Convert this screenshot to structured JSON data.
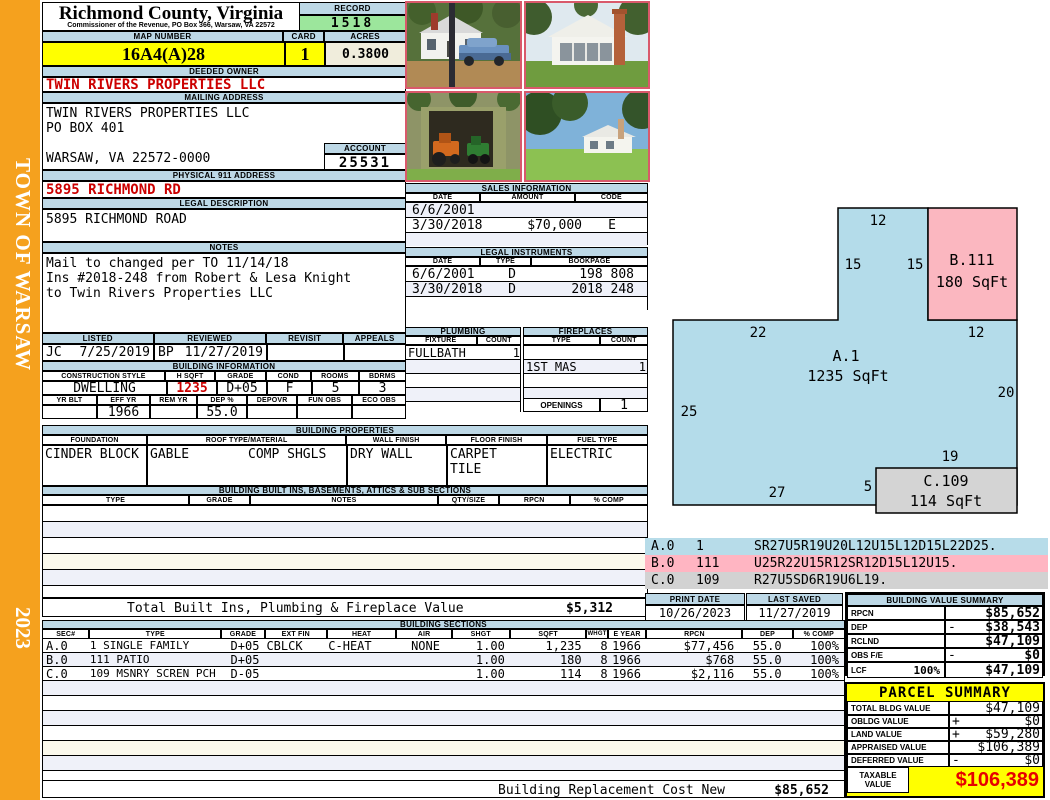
{
  "sidebar": {
    "town": "TOWN OF WARSAW",
    "year": "2023"
  },
  "header": {
    "county": "Richmond County, Virginia",
    "commissioner": "Commissioner of the Revenue, PO Box 366, Warsaw, VA 22572",
    "record_label": "RECORD",
    "record_value": "1518",
    "map_label": "MAP NUMBER",
    "map_value": "16A4(A)28",
    "card_label": "CARD",
    "card_value": "1",
    "acres_label": "ACRES",
    "acres_value": "0.3800"
  },
  "owner": {
    "label": "DEEDED OWNER",
    "value": "TWIN RIVERS PROPERTIES LLC"
  },
  "mailing": {
    "label": "MAILING ADDRESS",
    "line1": "TWIN RIVERS PROPERTIES LLC",
    "line2": "PO BOX 401",
    "line3": "WARSAW, VA 22572-0000"
  },
  "account": {
    "label": "ACCOUNT",
    "value": "25531"
  },
  "physical": {
    "label": "PHYSICAL 911 ADDRESS",
    "value": "5895 RICHMOND RD"
  },
  "legal": {
    "label": "LEGAL DESCRIPTION",
    "value": "5895 RICHMOND ROAD"
  },
  "notes": {
    "label": "NOTES",
    "line1": "Mail to changed per TO 11/14/18",
    "line2": "Ins #2018-248 from Robert & Lesa Knight",
    "line3": "to Twin Rivers Properties LLC"
  },
  "review": {
    "listed_label": "LISTED",
    "reviewed_label": "REVIEWED",
    "revisit_label": "REVISIT",
    "appeals_label": "APPEALS",
    "listed_by": "JC",
    "listed_date": "7/25/2019",
    "reviewed_by": "BP",
    "reviewed_date": "11/27/2019"
  },
  "building_info": {
    "title": "BUILDING INFORMATION",
    "h1": [
      "CONSTRUCTION STYLE",
      "H SQFT",
      "GRADE",
      "COND",
      "ROOMS",
      "BDRMS"
    ],
    "v1": [
      "DWELLING",
      "1235",
      "D+05",
      "F",
      "5",
      "3"
    ],
    "h2": [
      "YR BLT",
      "EFF YR",
      "REM YR",
      "DEP %",
      "DEPOVR",
      "FUN OBS",
      "ECO OBS"
    ],
    "v2": [
      "",
      "1966",
      "",
      "55.0",
      "",
      "",
      ""
    ]
  },
  "sales": {
    "title": "SALES INFORMATION",
    "h": [
      "DATE",
      "AMOUNT",
      "CODE"
    ],
    "rows": [
      [
        "6/6/2001",
        "",
        ""
      ],
      [
        "3/30/2018",
        "$70,000",
        "E"
      ],
      [
        "",
        "",
        ""
      ]
    ]
  },
  "instruments": {
    "title": "LEGAL INSTRUMENTS",
    "h": [
      "DATE",
      "TYPE",
      "BOOKPAGE"
    ],
    "rows": [
      [
        "6/6/2001",
        "D",
        "198 808"
      ],
      [
        "3/30/2018",
        "D",
        "2018 248"
      ],
      [
        "",
        "",
        ""
      ]
    ]
  },
  "plumbing": {
    "title": "PLUMBING",
    "h": [
      "FIXTURE",
      "COUNT"
    ],
    "rows": [
      [
        "FULLBATH",
        "1"
      ]
    ]
  },
  "fireplaces": {
    "title": "FIREPLACES",
    "h": [
      "TYPE",
      "COUNT"
    ],
    "rows": [
      [
        "",
        ""
      ],
      [
        "1ST MAS",
        "1"
      ]
    ],
    "openings_label": "OPENINGS",
    "openings_value": "1"
  },
  "properties": {
    "title": "BUILDING PROPERTIES",
    "h": [
      "FOUNDATION",
      "ROOF TYPE/MATERIAL",
      "WALL FINISH",
      "FLOOR FINISH",
      "FUEL TYPE"
    ],
    "foundation": "CINDER BLOCK",
    "roof_type": "GABLE",
    "roof_material": "COMP SHGLS",
    "wall": "DRY WALL",
    "floor1": "CARPET",
    "floor2": "TILE",
    "fuel": "ELECTRIC"
  },
  "builtins": {
    "title": "BUILDING BUILT INS, BASEMENTS, ATTICS & SUB SECTIONS",
    "h": [
      "TYPE",
      "GRADE",
      "NOTES",
      "QTY/SIZE",
      "RPCN",
      "% COMP"
    ],
    "total_label": "Total Built Ins, Plumbing & Fireplace Value",
    "total_value": "$5,312"
  },
  "sections": {
    "title": "BUILDING SECTIONS",
    "h": [
      "SEC#",
      "TYPE",
      "GRADE",
      "EXT FIN",
      "HEAT",
      "AIR",
      "SHGT",
      "SQFT",
      "WHGT",
      "E YEAR",
      "RPCN",
      "DEP",
      "% COMP"
    ],
    "rows": [
      {
        "sec": "A.0",
        "type": "1 SINGLE FAMILY",
        "grade": "D+05",
        "ext": "CBLCK",
        "heat": "C-HEAT",
        "air": "NONE",
        "shgt": "1.00",
        "sqft": "1,235",
        "whgt": "8",
        "eyear": "1966",
        "rpcn": "$77,456",
        "dep": "55.0",
        "comp": "100%"
      },
      {
        "sec": "B.0",
        "type": "111 PATIO",
        "grade": "D+05",
        "ext": "",
        "heat": "",
        "air": "",
        "shgt": "1.00",
        "sqft": "180",
        "whgt": "8",
        "eyear": "1966",
        "rpcn": "$768",
        "dep": "55.0",
        "comp": "100%"
      },
      {
        "sec": "C.0",
        "type": "109 MSNRY SCREN PCH",
        "grade": "D-05",
        "ext": "",
        "heat": "",
        "air": "",
        "shgt": "1.00",
        "sqft": "114",
        "whgt": "8",
        "eyear": "1966",
        "rpcn": "$2,116",
        "dep": "55.0",
        "comp": "100%"
      }
    ],
    "replacement_label": "Building Replacement Cost New",
    "replacement_value": "$85,652"
  },
  "vectors": {
    "rows": [
      {
        "sec": "A.0",
        "num": "1",
        "path": "SR27U5R19U20L12U15L12D15L22D25."
      },
      {
        "sec": "B.0",
        "num": "111",
        "path": "U25R22U15R12SR12D15L12U15."
      },
      {
        "sec": "C.0",
        "num": "109",
        "path": "R27U5SD6R19U6L19."
      }
    ]
  },
  "dates": {
    "print_label": "PRINT DATE",
    "print_value": "10/26/2023",
    "saved_label": "LAST SAVED",
    "saved_value": "11/27/2019"
  },
  "value_summary": {
    "title": "BUILDING VALUE SUMMARY",
    "rows": [
      {
        "label": "RPCN",
        "pct": "",
        "sign": "",
        "value": "$85,652"
      },
      {
        "label": "DEP",
        "pct": "",
        "sign": "-",
        "value": "$38,543"
      },
      {
        "label": "RCLND",
        "pct": "",
        "sign": "",
        "value": "$47,109"
      },
      {
        "label": "OBS F/E",
        "pct": "",
        "sign": "-",
        "value": "$0"
      },
      {
        "label": "LCF",
        "pct": "100%",
        "sign": "",
        "value": "$47,109"
      }
    ]
  },
  "parcel": {
    "title": "PARCEL SUMMARY",
    "rows": [
      {
        "label": "TOTAL BLDG VALUE",
        "sign": "",
        "value": "$47,109"
      },
      {
        "label": "OBLDG VALUE",
        "sign": "+",
        "value": "$0"
      },
      {
        "label": "LAND VALUE",
        "sign": "+",
        "value": "$59,280"
      },
      {
        "label": "APPRAISED VALUE",
        "sign": "",
        "value": "$106,389"
      },
      {
        "label": "DEFERRED VALUE",
        "sign": "-",
        "value": "$0"
      }
    ],
    "taxable_label1": "TAXABLE",
    "taxable_label2": "VALUE",
    "taxable_value": "$106,389"
  },
  "sketch": {
    "a_id": "A.1",
    "a_sqft": "1235 SqFt",
    "b_id": "B.111",
    "b_sqft": "180 SqFt",
    "c_id": "C.109",
    "c_sqft": "114 SqFt",
    "dims": {
      "top": "12",
      "tower_left": "15",
      "tower_right": "15",
      "b_bottom": "12",
      "main_top": "22",
      "right": "20",
      "left": "25",
      "c_top": "19",
      "c_left": "5",
      "bottom": "27"
    }
  },
  "colors": {
    "accent_orange": "#F5A11E",
    "header_blue": "#BDD8E6",
    "highlight_yellow": "#FFFF00",
    "record_green": "#9CE69C",
    "alert_red": "#CC0000"
  }
}
